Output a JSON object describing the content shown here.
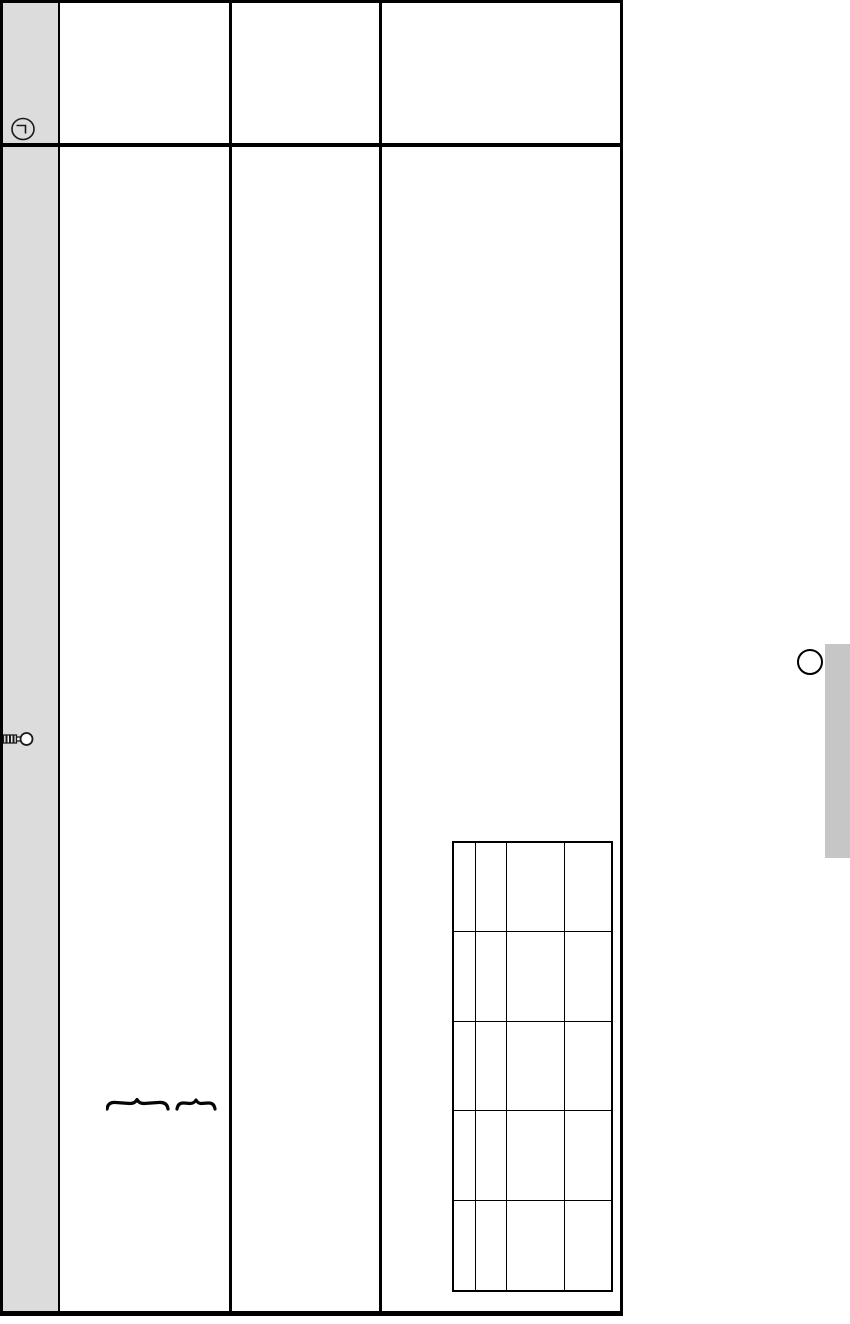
{
  "colors": {
    "page_background": "#ffffff",
    "table_border": "#000000",
    "margin_strip": "#dcdcdc",
    "side_tab": "#c6c6c6",
    "icon_stroke": "#1a1a1a"
  },
  "main_table": {
    "column_count": 4,
    "header_row_count": 1,
    "body_row_count": 1,
    "all_cells_empty": true
  },
  "inner_table": {
    "row_count": 5,
    "column_count": 4,
    "column_widths_px": [
      22,
      31,
      58,
      47
    ],
    "all_cells_empty": true
  },
  "margin_icons": [
    {
      "name": "clock-icon"
    },
    {
      "name": "key-icon"
    }
  ],
  "annotations": {
    "brace_count": 2
  },
  "right_margin": {
    "circle_marker": true,
    "side_tab": true
  }
}
